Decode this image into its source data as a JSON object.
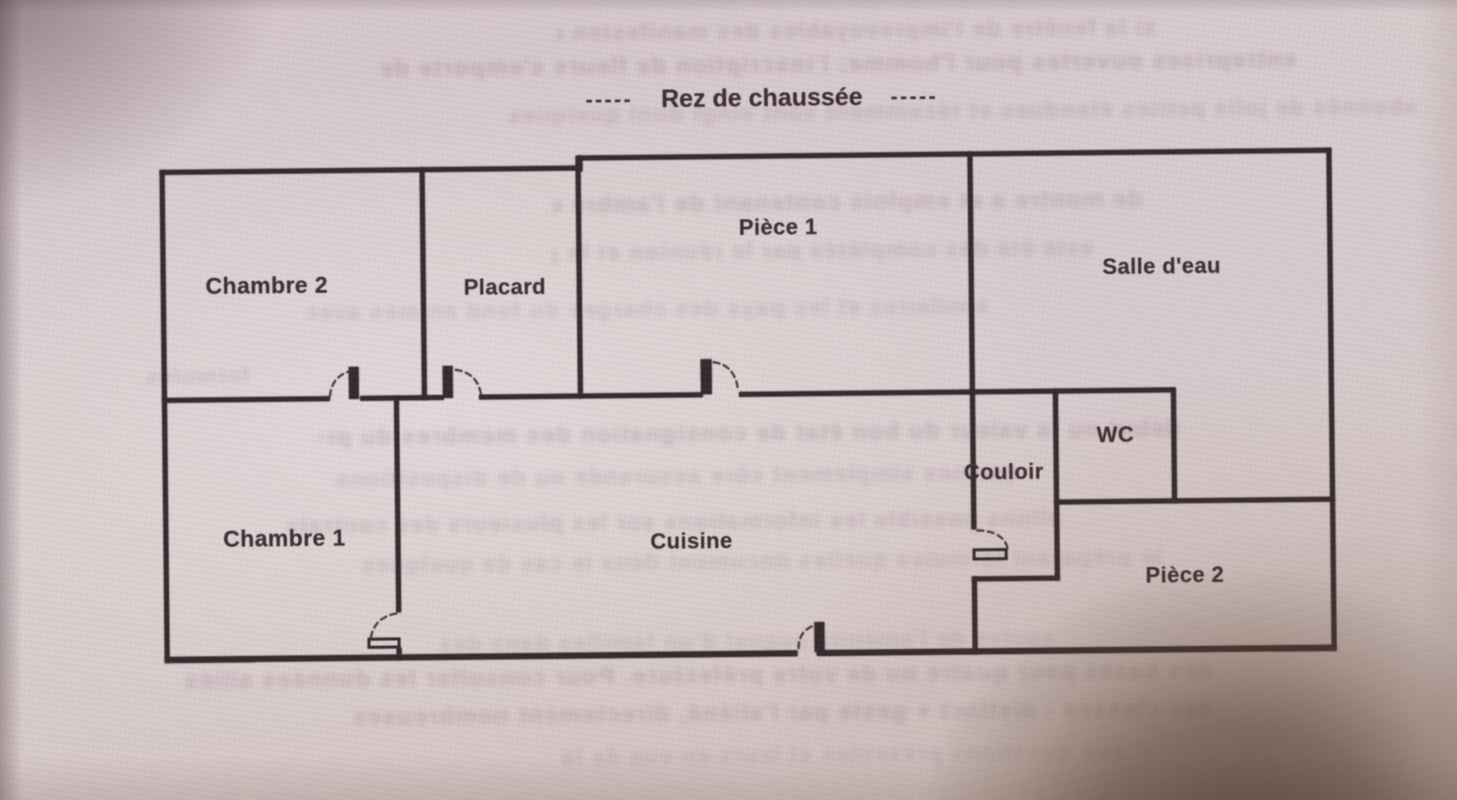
{
  "page": {
    "title": {
      "dashes_left": "-----",
      "text": "Rez de chaussée",
      "dashes_right": "-----"
    }
  },
  "rooms": [
    {
      "name": "Chambre 2"
    },
    {
      "name": "Placard"
    },
    {
      "name": "Pièce 1"
    },
    {
      "name": "Salle d'eau"
    },
    {
      "name": "WC"
    },
    {
      "name": "Couloir"
    },
    {
      "name": "Chambre 1"
    },
    {
      "name": "Cuisine"
    },
    {
      "name": "Pièce 2"
    }
  ],
  "colors": {
    "paper": "#d6c8ca",
    "ink": "#33282b",
    "bleed_text": "#8c7585",
    "corner_shadow": "#4a3322"
  },
  "artifacts": {
    "description_of_overlays": "photograph of a printed page: mirrored text bleeding through from reverse side, dark finger shadow bottom-right corner",
    "bleed_lines": [
      {
        "text": "si la fenêtre de l'imprevoyables des manifesten du faites"
      },
      {
        "text": "entreprises ouvertes pour l'homme; l'inscription de fleurs s'emporte de"
      },
      {
        "text": "abonnés de jolis petites étendues et récemment sont vingt dont quelques"
      },
      {
        "text": "de montre a et emplois contenant de l'ambre est en provision"
      },
      {
        "text": "este été des complétés par le réunion et le prise en des"
      },
      {
        "text": "similaires et les pays des charges du fond en mes avec"
      },
      {
        "text": "formules"
      },
      {
        "text": "début ou la valeur du bon état de consignation des membres du procédé"
      },
      {
        "text": "que nos simplement sûre assurande ou de dispositions"
      },
      {
        "text": "allons possible les informations sur les plusieurs des contrats"
      },
      {
        "text": "le préparant formules quelles document dans le cas de quelques"
      },
      {
        "text": "routes de l'aménité auquel d'un familles dans des"
      },
      {
        "text": "des bases pour quatre ou de votre préfecture. Pour consulter les données alliés"
      },
      {
        "text": "des classes - distinct + geste par l'aliéné, directement nombreuses"
      },
      {
        "text": "aux questions présentes et leurs en vue de la"
      }
    ]
  }
}
